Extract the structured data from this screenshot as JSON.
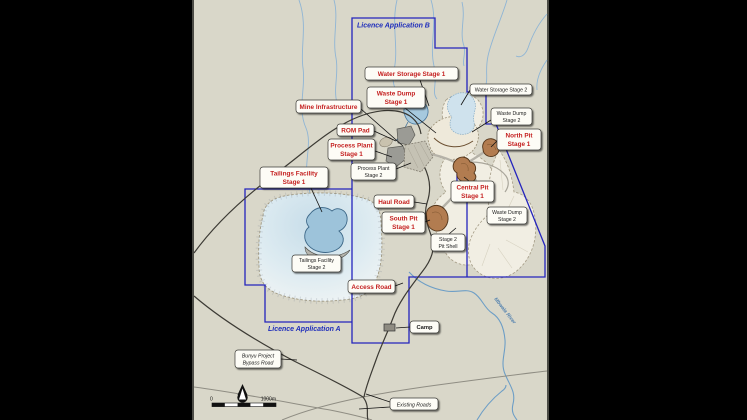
{
  "map_title": "Bunyu Project site layout map",
  "licences": {
    "b": "Licence Application B",
    "a": "Licence Application A"
  },
  "red_callouts": [
    {
      "id": "water-storage-stage-1",
      "lines": [
        "Water Storage Stage 1"
      ]
    },
    {
      "id": "waste-dump-stage-1",
      "lines": [
        "Waste Dump",
        "Stage 1"
      ]
    },
    {
      "id": "mine-infrastructure",
      "lines": [
        "Mine Infrastructure"
      ]
    },
    {
      "id": "rom-pad",
      "lines": [
        "ROM Pad"
      ]
    },
    {
      "id": "process-plant-stage-1",
      "lines": [
        "Process Plant",
        "Stage 1"
      ]
    },
    {
      "id": "tailings-facility-stage-1",
      "lines": [
        "Tailings Facility",
        "Stage 1"
      ]
    },
    {
      "id": "haul-road",
      "lines": [
        "Haul Road"
      ]
    },
    {
      "id": "central-pit-stage-1",
      "lines": [
        "Central Pit",
        "Stage 1"
      ]
    },
    {
      "id": "north-pit-stage-1",
      "lines": [
        "North Pit",
        "Stage 1"
      ]
    },
    {
      "id": "south-pit-stage-1",
      "lines": [
        "South Pit",
        "Stage 1"
      ]
    },
    {
      "id": "access-road",
      "lines": [
        "Access Road"
      ]
    }
  ],
  "white_callouts": [
    {
      "id": "water-storage-stage-2",
      "lines": [
        "Water Storage Stage 2"
      ]
    },
    {
      "id": "waste-dump-stage-2-north",
      "lines": [
        "Waste Dump",
        "Stage 2"
      ]
    },
    {
      "id": "process-plant-stage-2",
      "lines": [
        "Process Plant",
        "Stage 2"
      ]
    },
    {
      "id": "stage-2-pit-shell",
      "lines": [
        "Stage 2",
        "Pit Shell"
      ]
    },
    {
      "id": "waste-dump-stage-2",
      "lines": [
        "Waste Dump",
        "Stage 2"
      ]
    },
    {
      "id": "tailings-facility-stage-2",
      "lines": [
        "Tailings Facility",
        "Stage 2"
      ]
    },
    {
      "id": "camp",
      "lines": [
        "Camp"
      ]
    },
    {
      "id": "bunyu-project-bypass-road",
      "lines": [
        "Bunyu Project",
        "Bypass Road"
      ]
    },
    {
      "id": "existing-roads",
      "lines": [
        "Existing Roads"
      ]
    }
  ],
  "river_label": "Mbwala River",
  "scale_bar": {
    "zero": "0",
    "max": "1000m"
  },
  "north_arrow": "north-arrow",
  "colors": {
    "map_background": "#d9d7c9",
    "licence_boundary": "#2424bd",
    "callout_red_text": "#c41f1f",
    "water_fill": "#a6c9de",
    "pit_fill": "#b27c50",
    "waste_dump_fill": "#f1eee3"
  }
}
